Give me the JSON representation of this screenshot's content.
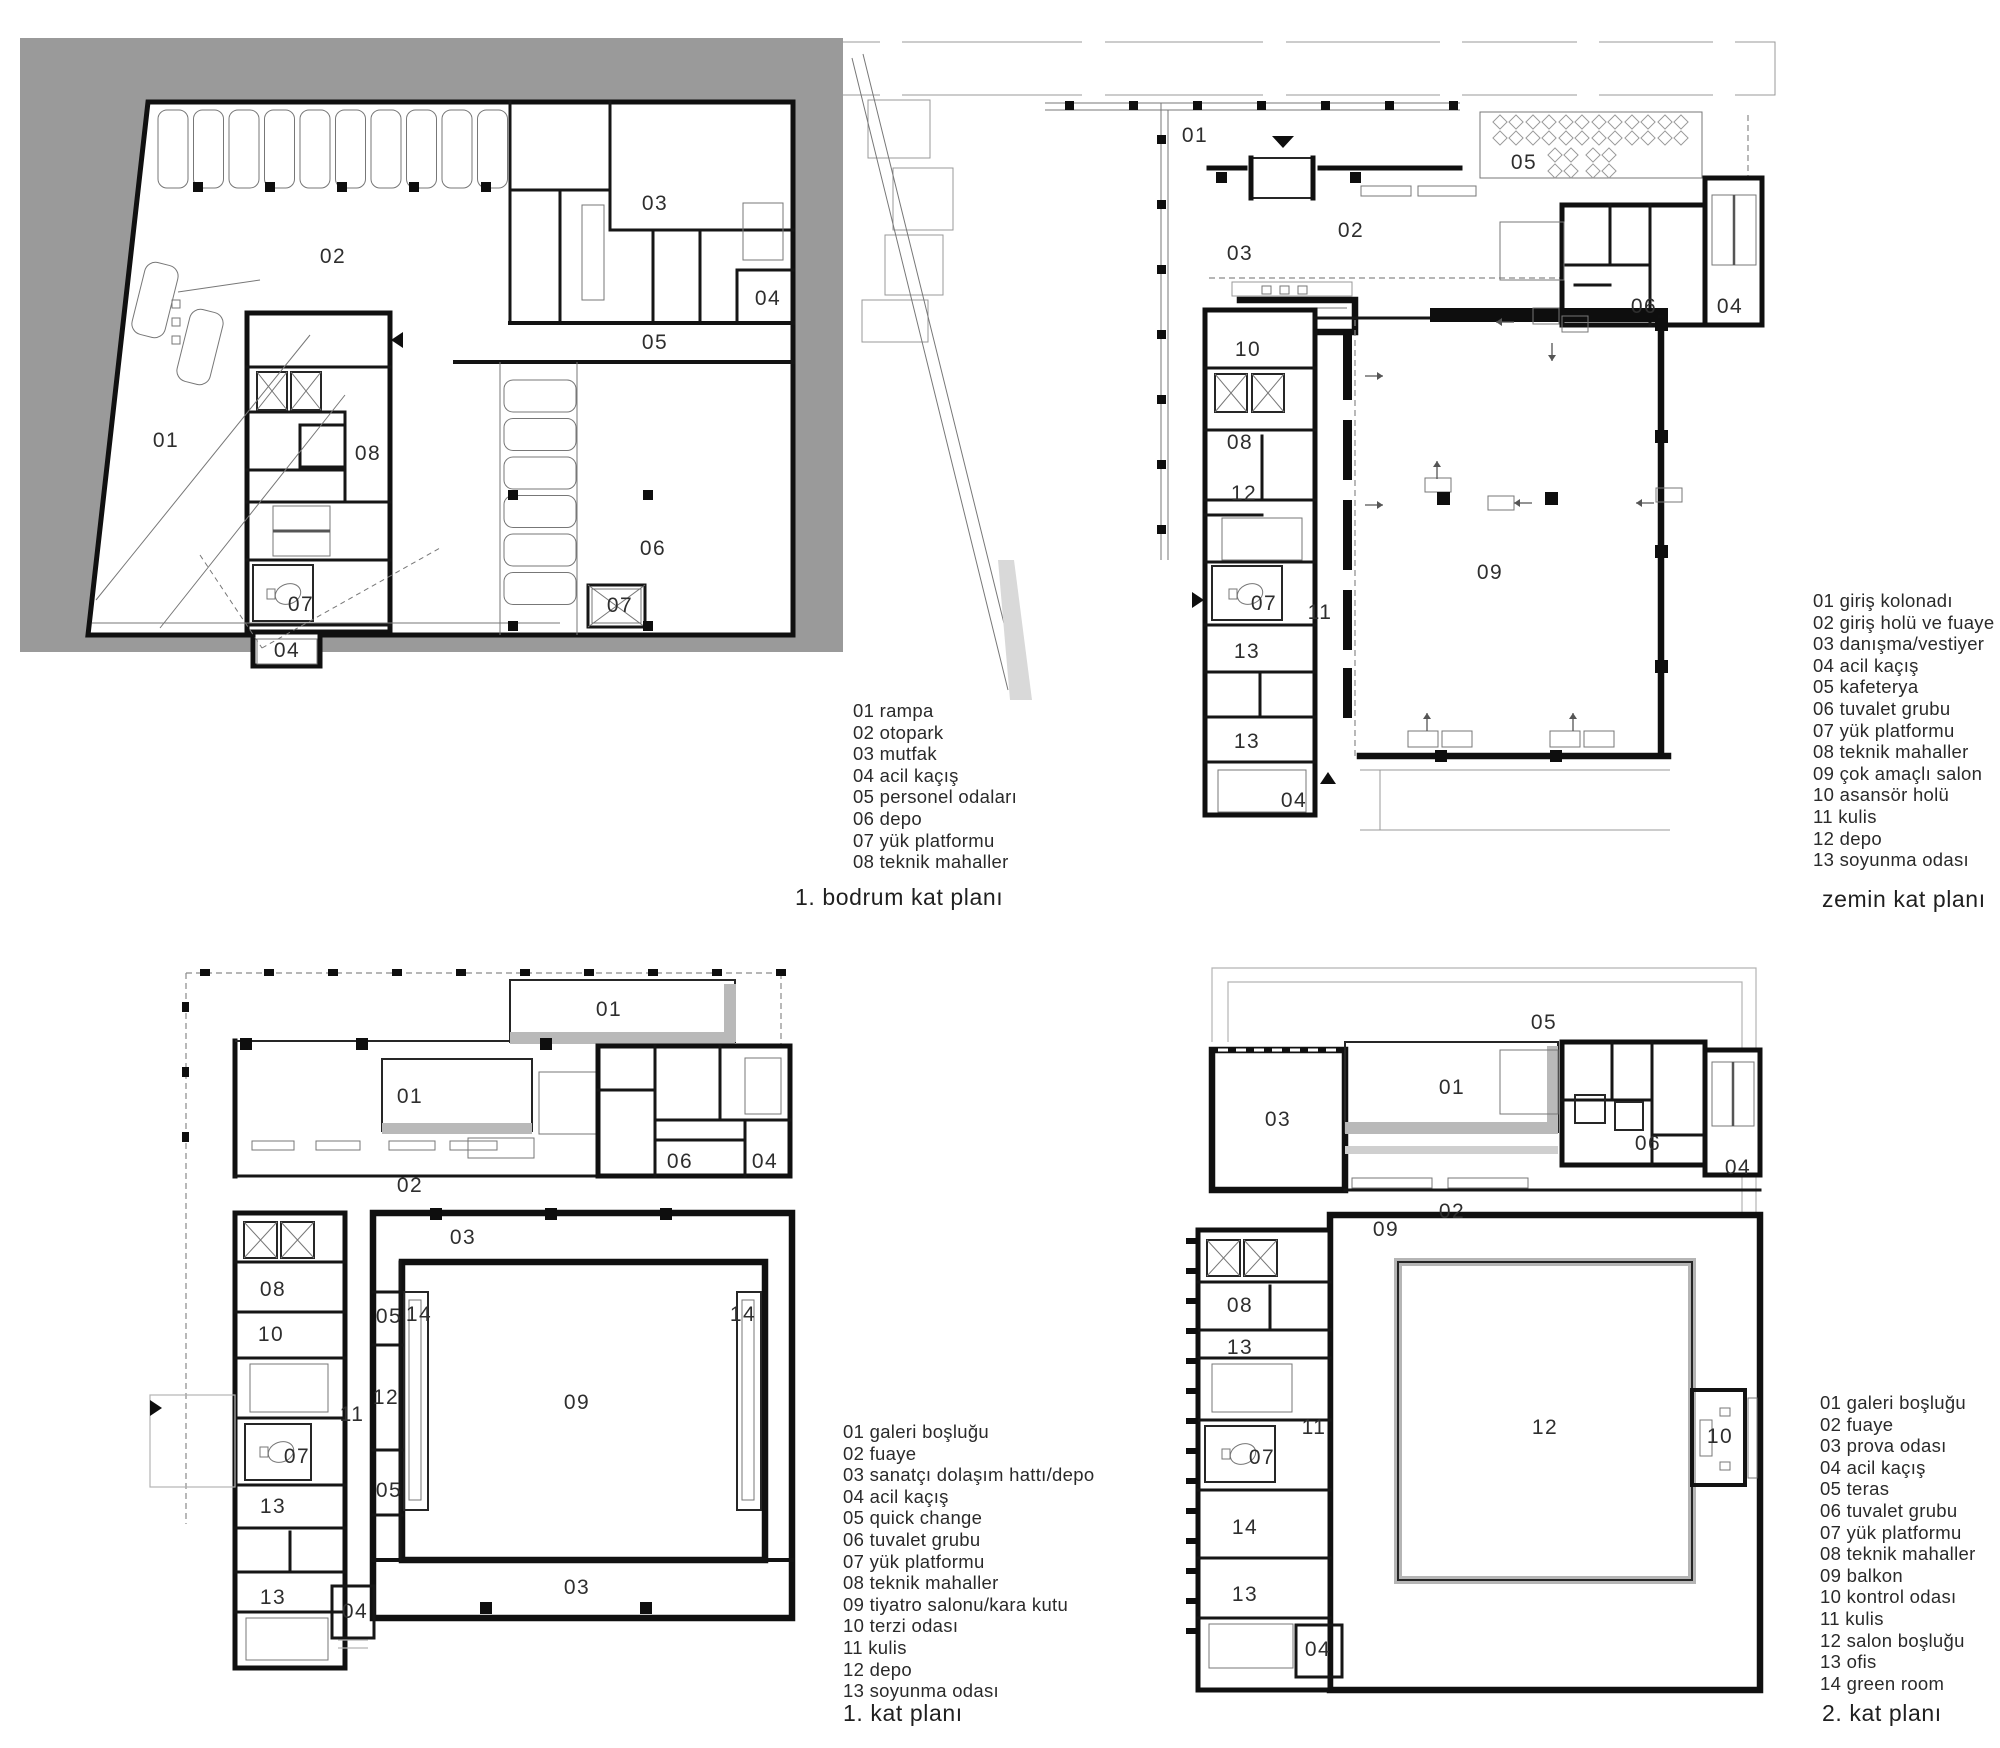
{
  "figure": {
    "poche_gray": "#9a9a9a",
    "band_gray": "#b9b9b9",
    "wall_ink": "#101010"
  },
  "plans": {
    "basement": {
      "title": "1. bodrum kat planı",
      "legend": [
        {
          "no": "01",
          "label": "rampa"
        },
        {
          "no": "02",
          "label": "otopark"
        },
        {
          "no": "03",
          "label": "mutfak"
        },
        {
          "no": "04",
          "label": "acil kaçış"
        },
        {
          "no": "05",
          "label": "personel odaları"
        },
        {
          "no": "06",
          "label": "depo"
        },
        {
          "no": "07",
          "label": "yük platformu"
        },
        {
          "no": "08",
          "label": "teknik mahaller"
        }
      ],
      "rooms": [
        {
          "no": "02",
          "x": 333,
          "y": 257
        },
        {
          "no": "03",
          "x": 655,
          "y": 204
        },
        {
          "no": "04",
          "x": 768,
          "y": 299
        },
        {
          "no": "05",
          "x": 655,
          "y": 343
        },
        {
          "no": "01",
          "x": 166,
          "y": 441
        },
        {
          "no": "08",
          "x": 368,
          "y": 454
        },
        {
          "no": "06",
          "x": 653,
          "y": 549
        },
        {
          "no": "07",
          "x": 301,
          "y": 605
        },
        {
          "no": "07",
          "x": 620,
          "y": 606
        },
        {
          "no": "04",
          "x": 287,
          "y": 651
        }
      ]
    },
    "ground": {
      "title": "zemin kat planı",
      "legend": [
        {
          "no": "01",
          "label": "giriş kolonadı"
        },
        {
          "no": "02",
          "label": "giriş holü ve fuaye"
        },
        {
          "no": "03",
          "label": "danışma/vestiyer"
        },
        {
          "no": "04",
          "label": "acil kaçış"
        },
        {
          "no": "05",
          "label": "kafeterya"
        },
        {
          "no": "06",
          "label": "tuvalet grubu"
        },
        {
          "no": "07",
          "label": "yük platformu"
        },
        {
          "no": "08",
          "label": "teknik mahaller"
        },
        {
          "no": "09",
          "label": "çok amaçlı salon"
        },
        {
          "no": "10",
          "label": "asansör holü"
        },
        {
          "no": "11",
          "label": "kulis"
        },
        {
          "no": "12",
          "label": "depo"
        },
        {
          "no": "13",
          "label": "soyunma odası"
        }
      ],
      "rooms": [
        {
          "no": "01",
          "x": 1195,
          "y": 136
        },
        {
          "no": "05",
          "x": 1524,
          "y": 163
        },
        {
          "no": "02",
          "x": 1351,
          "y": 231
        },
        {
          "no": "03",
          "x": 1240,
          "y": 254
        },
        {
          "no": "06",
          "x": 1644,
          "y": 307
        },
        {
          "no": "04",
          "x": 1730,
          "y": 307
        },
        {
          "no": "10",
          "x": 1248,
          "y": 350
        },
        {
          "no": "08",
          "x": 1240,
          "y": 443
        },
        {
          "no": "12",
          "x": 1244,
          "y": 494
        },
        {
          "no": "09",
          "x": 1490,
          "y": 573
        },
        {
          "no": "11",
          "x": 1320,
          "y": 613
        },
        {
          "no": "07",
          "x": 1264,
          "y": 604
        },
        {
          "no": "13",
          "x": 1247,
          "y": 652
        },
        {
          "no": "13",
          "x": 1247,
          "y": 742
        },
        {
          "no": "04",
          "x": 1294,
          "y": 801
        }
      ]
    },
    "first": {
      "title": "1. kat planı",
      "legend": [
        {
          "no": "01",
          "label": "galeri boşluğu"
        },
        {
          "no": "02",
          "label": "fuaye"
        },
        {
          "no": "03",
          "label": "sanatçı dolaşım hattı/depo"
        },
        {
          "no": "04",
          "label": "acil kaçış"
        },
        {
          "no": "05",
          "label": "quick change"
        },
        {
          "no": "06",
          "label": "tuvalet grubu"
        },
        {
          "no": "07",
          "label": "yük platformu"
        },
        {
          "no": "08",
          "label": "teknik mahaller"
        },
        {
          "no": "09",
          "label": "tiyatro salonu/kara kutu"
        },
        {
          "no": "10",
          "label": "terzi odası"
        },
        {
          "no": "11",
          "label": "kulis"
        },
        {
          "no": "12",
          "label": "depo"
        },
        {
          "no": "13",
          "label": "soyunma odası"
        }
      ],
      "rooms": [
        {
          "no": "01",
          "x": 609,
          "y": 1010
        },
        {
          "no": "01",
          "x": 410,
          "y": 1097
        },
        {
          "no": "06",
          "x": 680,
          "y": 1162
        },
        {
          "no": "04",
          "x": 765,
          "y": 1162
        },
        {
          "no": "02",
          "x": 410,
          "y": 1186
        },
        {
          "no": "03",
          "x": 463,
          "y": 1238
        },
        {
          "no": "08",
          "x": 273,
          "y": 1290
        },
        {
          "no": "10",
          "x": 271,
          "y": 1335
        },
        {
          "no": "05",
          "x": 389,
          "y": 1317
        },
        {
          "no": "14",
          "x": 419,
          "y": 1315
        },
        {
          "no": "14",
          "x": 743,
          "y": 1315
        },
        {
          "no": "12",
          "x": 386,
          "y": 1398
        },
        {
          "no": "11",
          "x": 352,
          "y": 1415
        },
        {
          "no": "09",
          "x": 577,
          "y": 1403
        },
        {
          "no": "07",
          "x": 297,
          "y": 1457
        },
        {
          "no": "13",
          "x": 273,
          "y": 1507
        },
        {
          "no": "05",
          "x": 389,
          "y": 1491
        },
        {
          "no": "13",
          "x": 273,
          "y": 1598
        },
        {
          "no": "03",
          "x": 577,
          "y": 1588
        },
        {
          "no": "04",
          "x": 355,
          "y": 1612
        }
      ]
    },
    "second": {
      "title": "2. kat planı",
      "legend": [
        {
          "no": "01",
          "label": "galeri boşluğu"
        },
        {
          "no": "02",
          "label": "fuaye"
        },
        {
          "no": "03",
          "label": "prova odası"
        },
        {
          "no": "04",
          "label": "acil kaçış"
        },
        {
          "no": "05",
          "label": "teras"
        },
        {
          "no": "06",
          "label": "tuvalet grubu"
        },
        {
          "no": "07",
          "label": "yük platformu"
        },
        {
          "no": "08",
          "label": "teknik mahaller"
        },
        {
          "no": "09",
          "label": "balkon"
        },
        {
          "no": "10",
          "label": "kontrol odası"
        },
        {
          "no": "11",
          "label": "kulis"
        },
        {
          "no": "12",
          "label": "salon boşluğu"
        },
        {
          "no": "13",
          "label": "ofis"
        },
        {
          "no": "14",
          "label": "green room"
        }
      ],
      "rooms": [
        {
          "no": "05",
          "x": 1544,
          "y": 1023
        },
        {
          "no": "03",
          "x": 1278,
          "y": 1120
        },
        {
          "no": "01",
          "x": 1452,
          "y": 1088
        },
        {
          "no": "06",
          "x": 1648,
          "y": 1144
        },
        {
          "no": "04",
          "x": 1738,
          "y": 1168
        },
        {
          "no": "02",
          "x": 1452,
          "y": 1212
        },
        {
          "no": "09",
          "x": 1386,
          "y": 1230
        },
        {
          "no": "08",
          "x": 1240,
          "y": 1306
        },
        {
          "no": "13",
          "x": 1240,
          "y": 1348
        },
        {
          "no": "12",
          "x": 1545,
          "y": 1428
        },
        {
          "no": "10",
          "x": 1720,
          "y": 1437
        },
        {
          "no": "11",
          "x": 1314,
          "y": 1428
        },
        {
          "no": "07",
          "x": 1262,
          "y": 1458
        },
        {
          "no": "14",
          "x": 1245,
          "y": 1528
        },
        {
          "no": "13",
          "x": 1245,
          "y": 1595
        },
        {
          "no": "04",
          "x": 1318,
          "y": 1650
        }
      ]
    }
  }
}
